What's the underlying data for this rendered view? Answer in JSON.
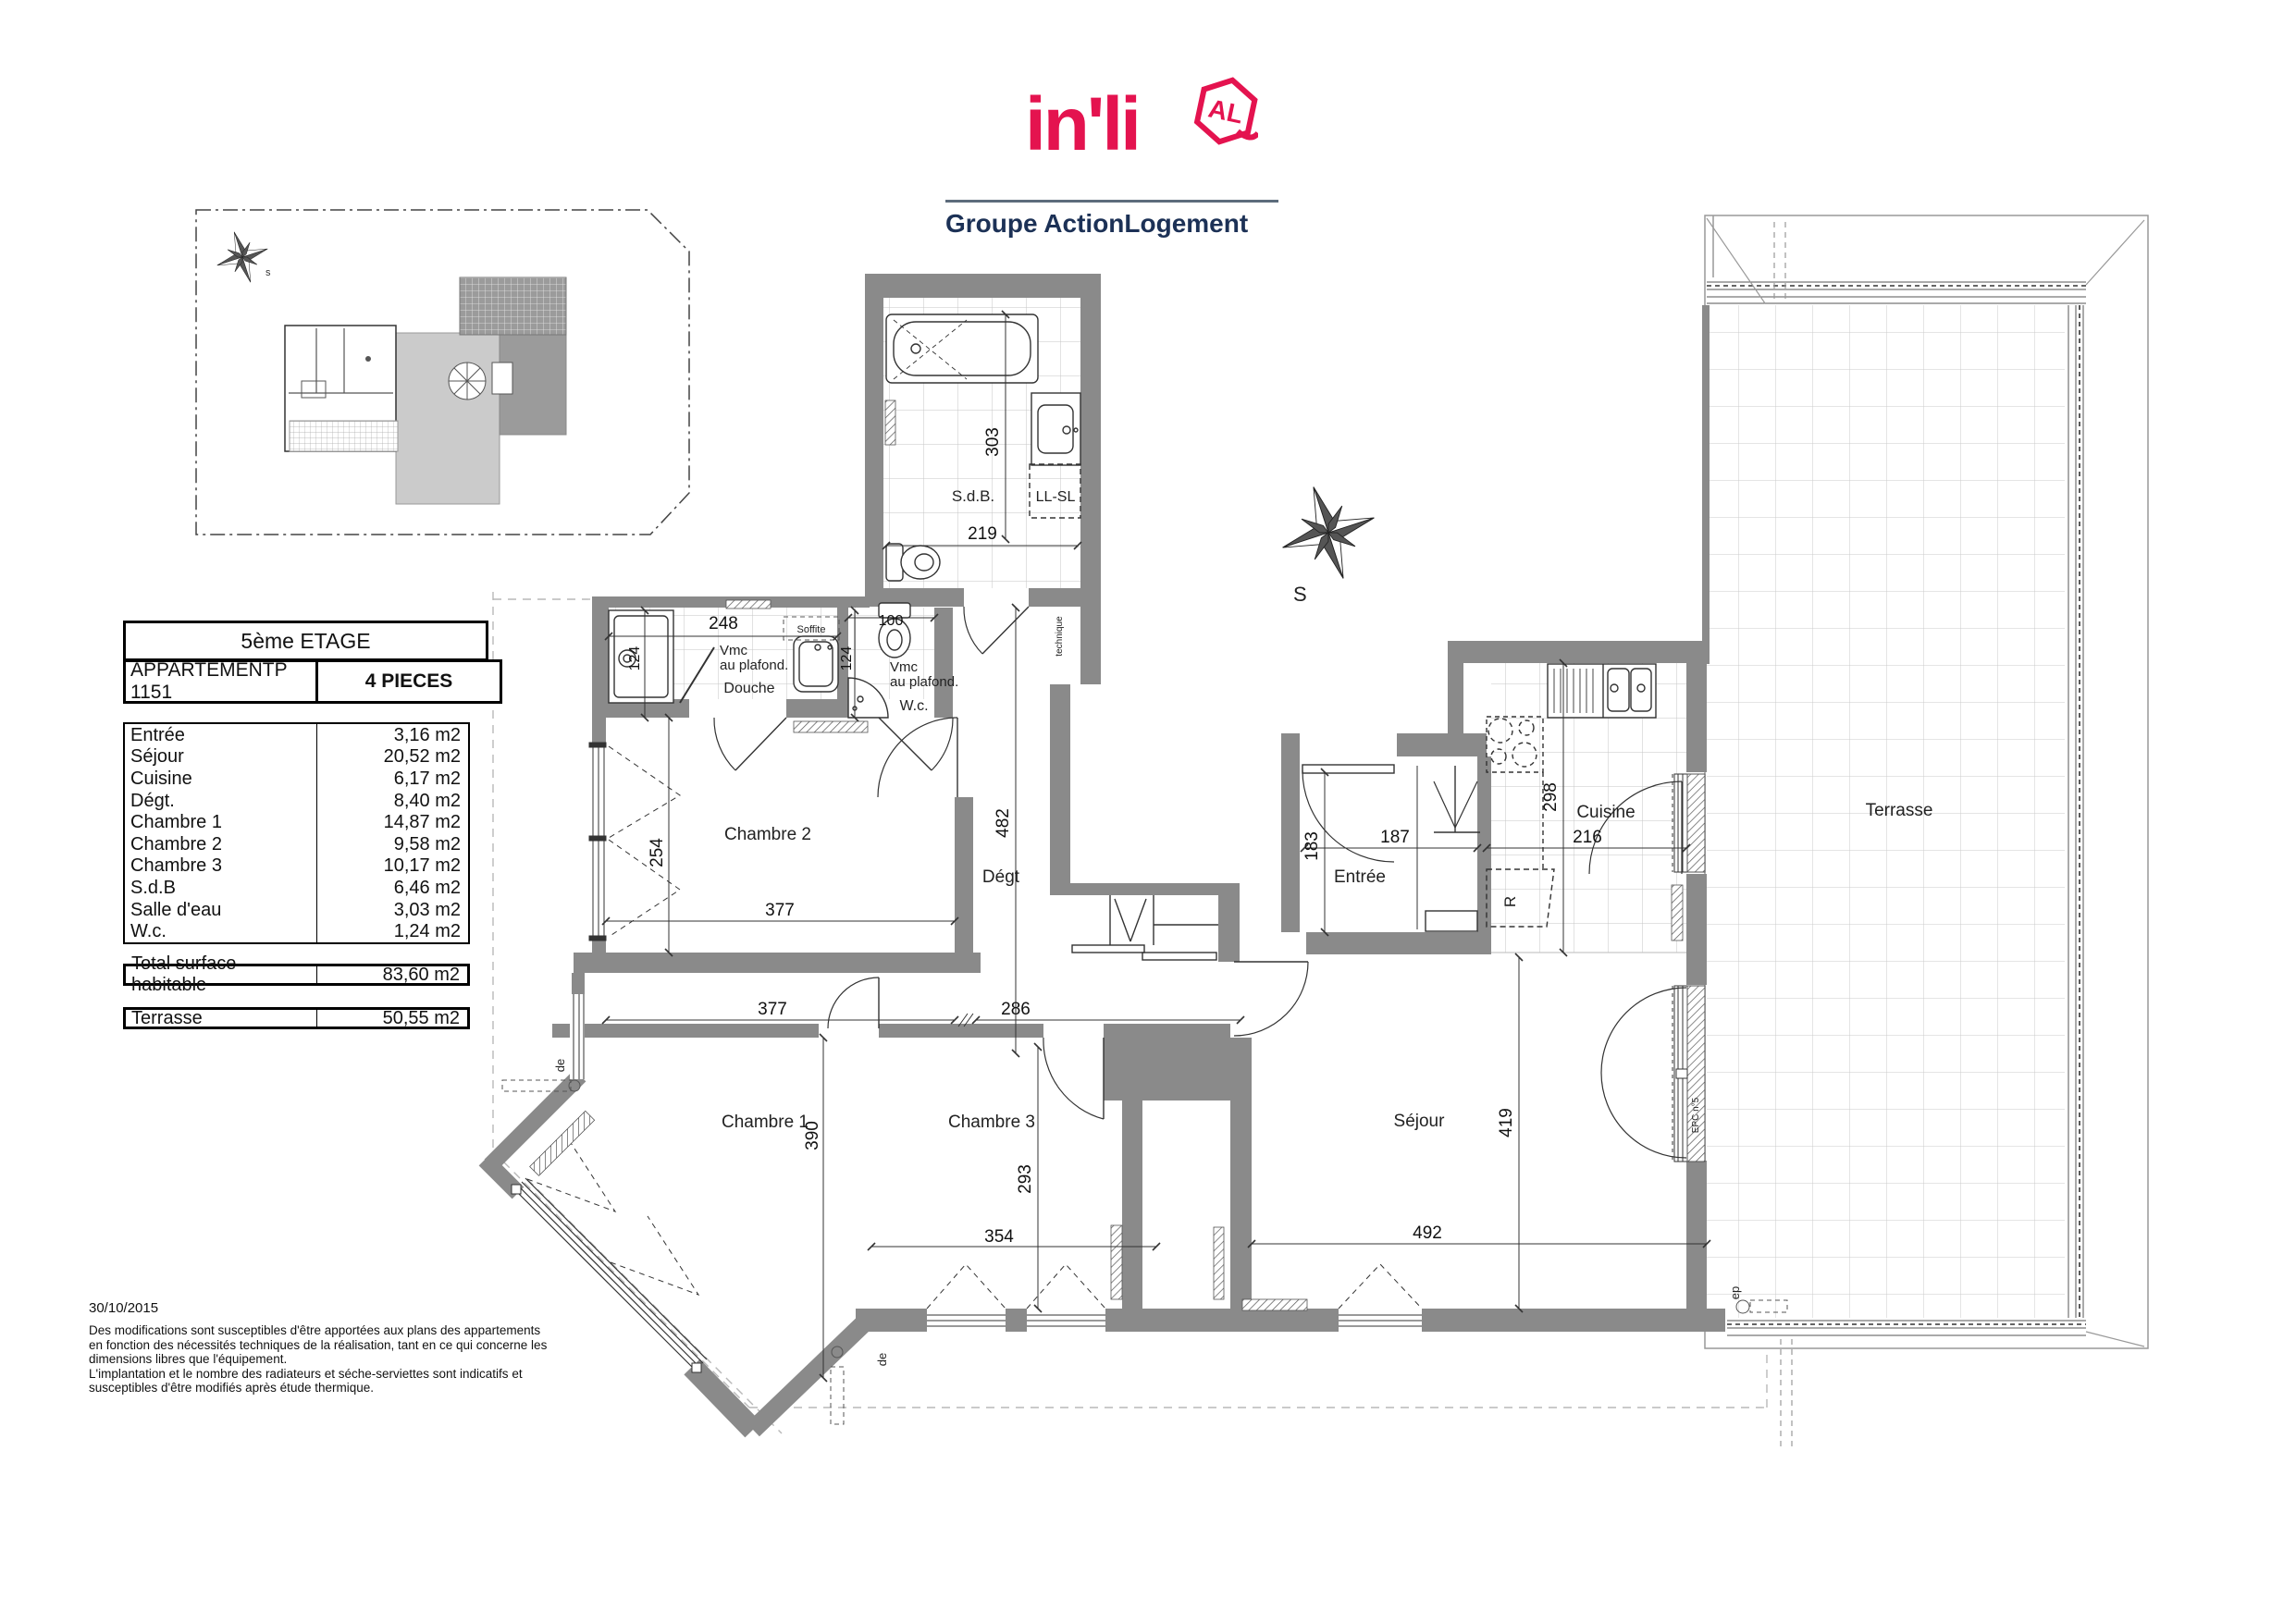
{
  "logo": {
    "brand": "in'li",
    "badge": "AL",
    "tagline": "Groupe ActionLogement",
    "brand_color": "#e4134f",
    "tagline_color": "#1c3156"
  },
  "title_block": {
    "floor": "5ème ETAGE",
    "apartment": "APPARTEMENTP 1151",
    "type": "4 PIECES",
    "rooms": [
      {
        "name": "Entrée",
        "area": "3,16 m2"
      },
      {
        "name": "Séjour",
        "area": "20,52 m2"
      },
      {
        "name": "Cuisine",
        "area": "6,17 m2"
      },
      {
        "name": "Dégt.",
        "area": "8,40 m2"
      },
      {
        "name": "Chambre 1",
        "area": "14,87 m2"
      },
      {
        "name": "Chambre 2",
        "area": "9,58 m2"
      },
      {
        "name": "Chambre 3",
        "area": "10,17 m2"
      },
      {
        "name": "S.d.B",
        "area": "6,46 m2"
      },
      {
        "name": "Salle d'eau",
        "area": "3,03 m2"
      },
      {
        "name": "W.c.",
        "area": "1,24 m2"
      }
    ],
    "total_label": "Total surface habitable",
    "total_area": "83,60 m2",
    "terrace_label": "Terrasse",
    "terrace_area": "50,55 m2"
  },
  "footer": {
    "date": "30/10/2015",
    "lines": [
      "Des modifications sont susceptibles d'être apportées aux plans des appartements",
      "en fonction des nécessités techniques de la réalisation, tant en ce qui concerne les",
      "dimensions libres que l'équipement.",
      "L'implantation et le nombre des radiateurs et séche-serviettes sont indicatifs et",
      "susceptibles d'être modifiés après étude thermique."
    ]
  },
  "plan": {
    "rooms": {
      "sdb": "S.d.B.",
      "llsl": "LL-SL",
      "douche": "Douche",
      "wc": "W.c.",
      "chambre2": "Chambre 2",
      "degt": "Dégt",
      "entree": "Entrée",
      "cuisine": "Cuisine",
      "sejour": "Séjour",
      "chambre1": "Chambre 1",
      "chambre3": "Chambre 3",
      "terrasse": "Terrasse"
    },
    "dims": {
      "sdb_h": "303",
      "sdb_w": "219",
      "sde_w": "248",
      "sde_h": "124",
      "wc_h": "124",
      "wc_w": "100",
      "ch2_h": "254",
      "ch2_w": "377",
      "degt_h": "482",
      "entree_h": "183",
      "entree_w": "187",
      "cuisine_h": "298",
      "cuisine_w": "216",
      "hall_left": "377",
      "hall_right": "286",
      "ch1_h": "390",
      "ch3_h": "293",
      "ch3_w": "354",
      "sejour_w": "492",
      "sejour_h": "419"
    },
    "annotations": {
      "vmc1_l1": "Vmc",
      "vmc1_l2": "au plafond.",
      "vmc2_l1": "Vmc",
      "vmc2_l2": "au plafond.",
      "soffite": "Soffite",
      "fridge": "R",
      "duct": "technique",
      "door_ref": "EPC n°5",
      "ep": "ep",
      "de1": "de",
      "de2": "de",
      "compass": "S",
      "site_compass": "s"
    }
  }
}
